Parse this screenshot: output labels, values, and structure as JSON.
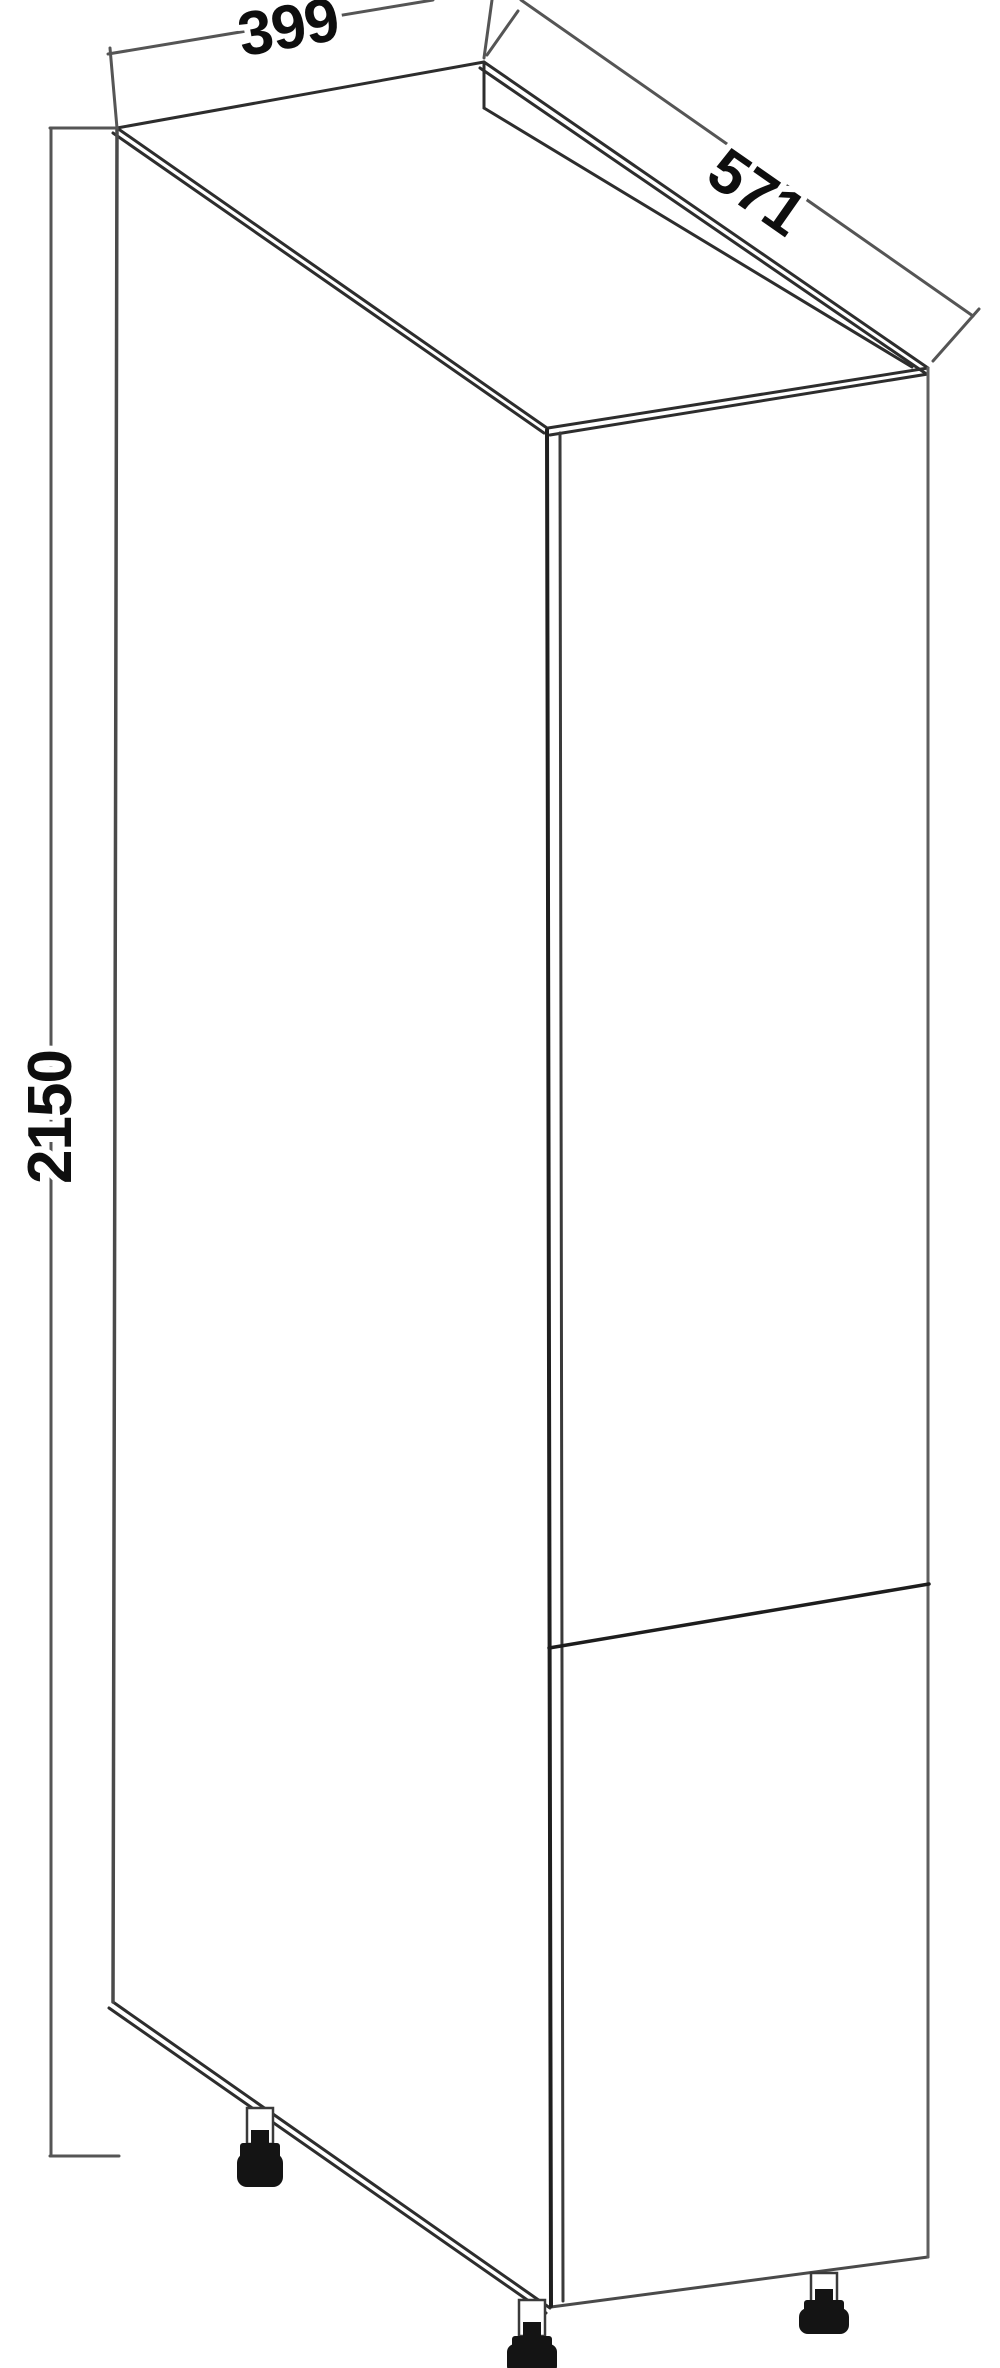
{
  "drawing": {
    "dimension_labels": {
      "width": "399",
      "depth": "571",
      "height": "2150"
    },
    "colors": {
      "background": "#ffffff",
      "edge": "#2d2d2d",
      "edge_secondary": "#4a4a4a",
      "edge_light": "#5f5f5f",
      "dimension_line": "#555555",
      "label_text": "#0e0e0e",
      "foot_fill": "#141414"
    }
  }
}
